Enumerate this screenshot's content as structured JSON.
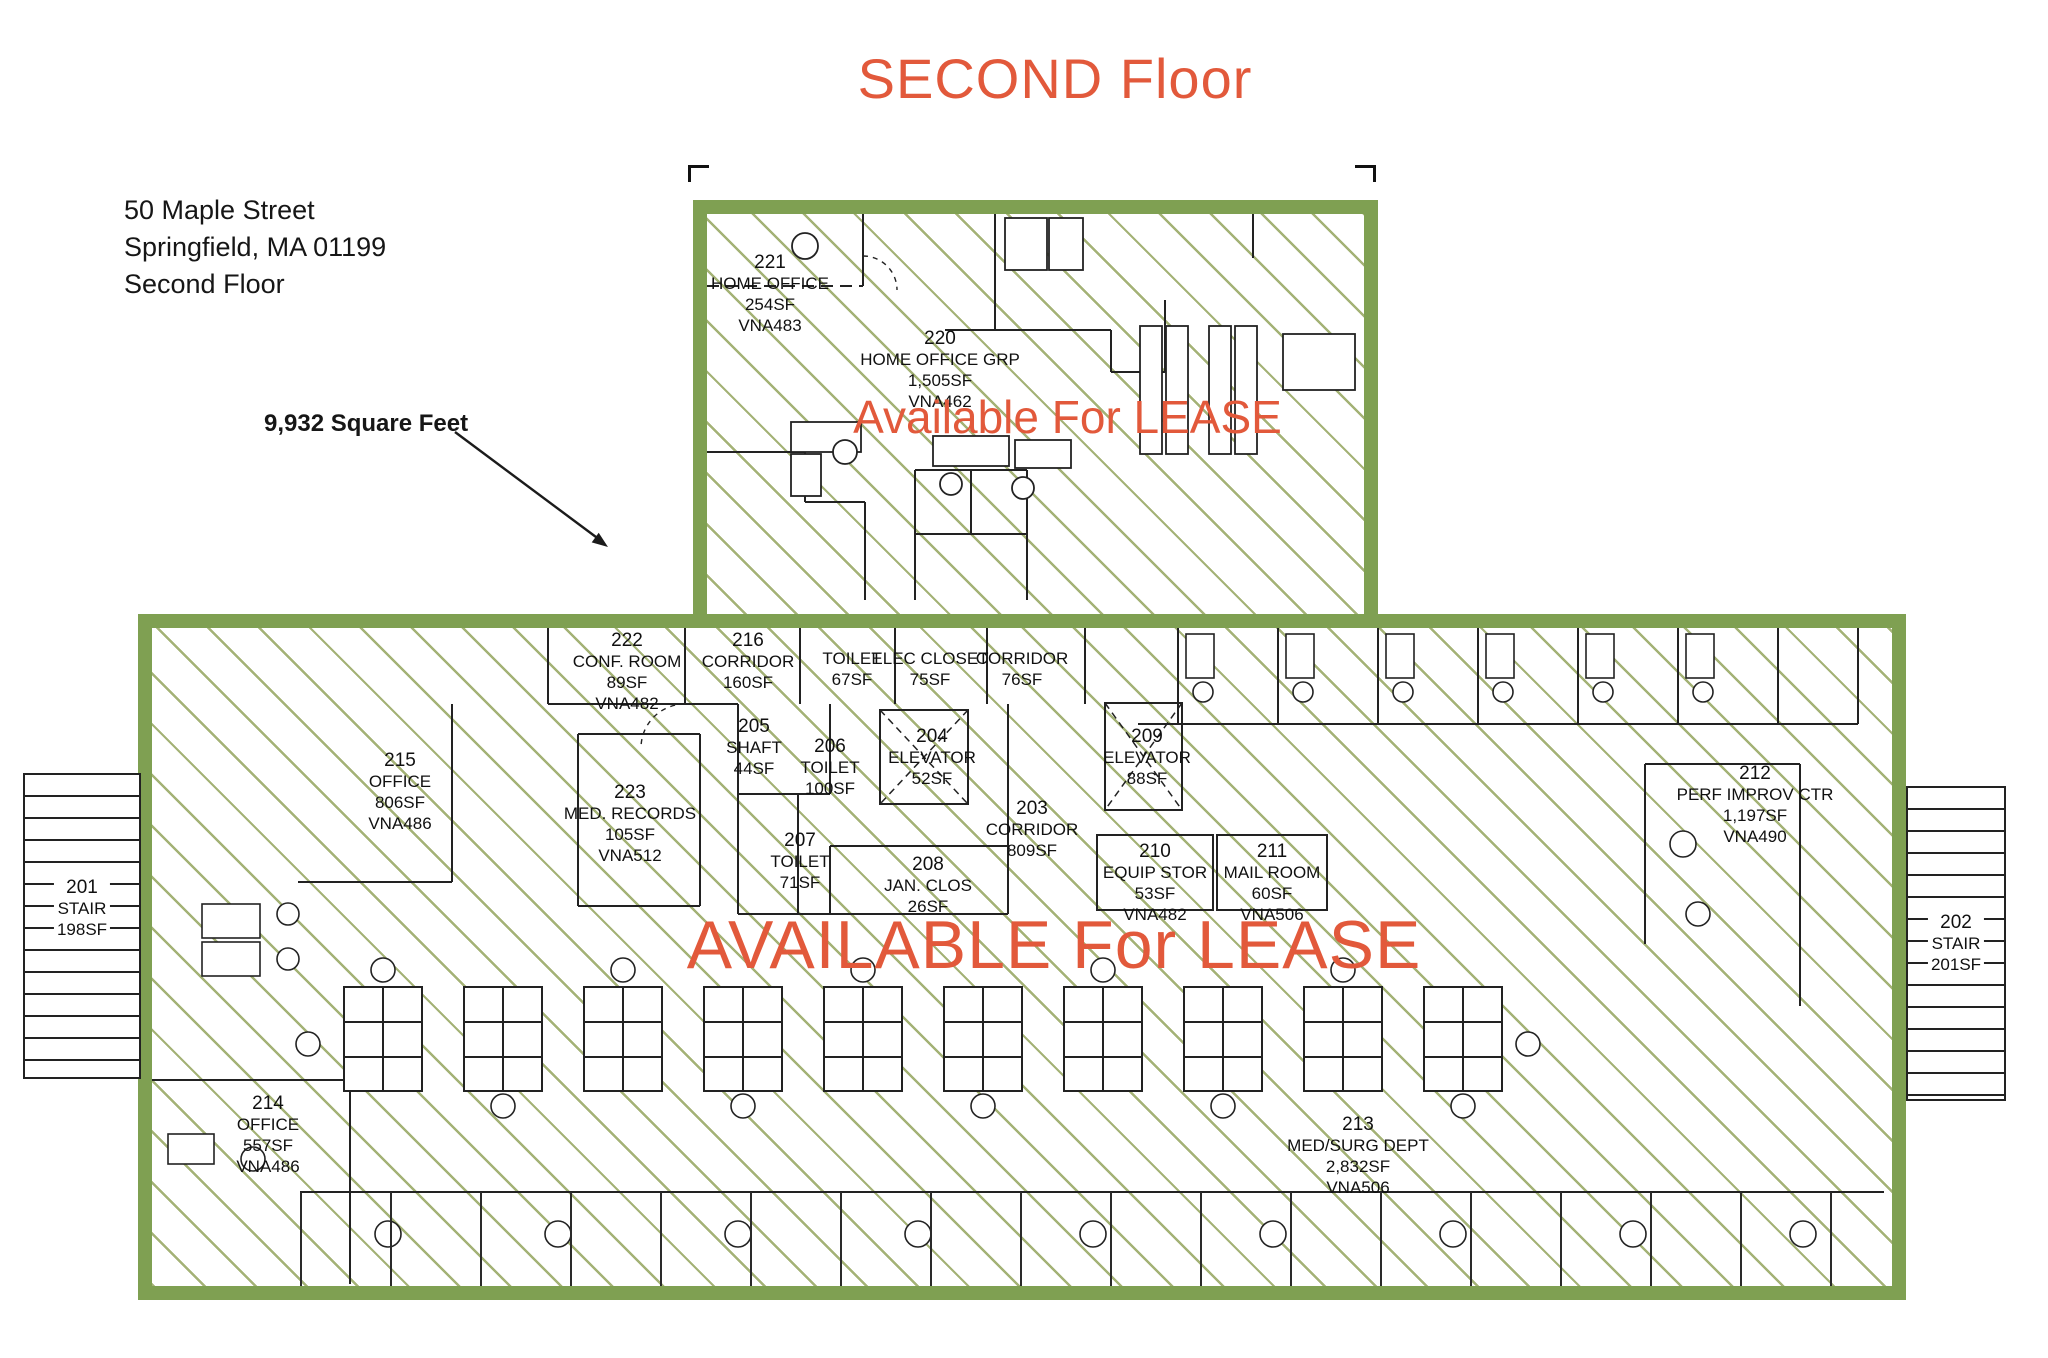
{
  "title": "SECOND Floor",
  "address": [
    "50 Maple Street",
    "Springfield, MA 01199",
    "Second Floor"
  ],
  "square_feet_note": "9,932 Square Feet",
  "lease": {
    "upper_label": "Available For LEASE",
    "lower_label": "AVAILABLE For LEASE"
  },
  "colors": {
    "accent_orange": "#E2593B",
    "lease_border_green": "#7FA052",
    "hatch_green": "#94A45E",
    "ink": "#1F1F1F"
  },
  "upper_unit": {
    "rooms": [
      {
        "number": "221",
        "name": "HOME OFFICE",
        "area": "254SF",
        "code": "VNA483"
      },
      {
        "number": "220",
        "name": "HOME OFFICE GRP",
        "area": "1,505SF",
        "code": "VNA462"
      }
    ]
  },
  "lower_unit": {
    "rooms": [
      {
        "number": "222",
        "name": "CONF. ROOM",
        "area": "89SF",
        "code": "VNA482"
      },
      {
        "number": "216",
        "name": "CORRIDOR",
        "area": "160SF"
      },
      {
        "name": "TOILET",
        "area": "67SF"
      },
      {
        "name": "ELEC CLOSET",
        "area": "75SF"
      },
      {
        "name": "CORRIDOR",
        "area": "76SF"
      },
      {
        "number": "215",
        "name": "OFFICE",
        "area": "806SF",
        "code": "VNA486"
      },
      {
        "number": "223",
        "name": "MED. RECORDS",
        "area": "105SF",
        "code": "VNA512"
      },
      {
        "number": "205",
        "name": "SHAFT",
        "area": "44SF"
      },
      {
        "number": "206",
        "name": "TOILET",
        "area": "100SF"
      },
      {
        "number": "204",
        "name": "ELEVATOR",
        "area": "52SF"
      },
      {
        "number": "207",
        "name": "TOILET",
        "area": "71SF"
      },
      {
        "number": "208",
        "name": "JAN. CLOS",
        "area": "26SF"
      },
      {
        "number": "203",
        "name": "CORRIDOR",
        "area": "809SF"
      },
      {
        "number": "209",
        "name": "ELEVATOR",
        "area": "88SF"
      },
      {
        "number": "210",
        "name": "EQUIP STOR",
        "area": "53SF",
        "code": "VNA482"
      },
      {
        "number": "211",
        "name": "MAIL ROOM",
        "area": "60SF",
        "code": "VNA506"
      },
      {
        "number": "212",
        "name": "PERF IMPROV CTR",
        "area": "1,197SF",
        "code": "VNA490"
      },
      {
        "number": "214",
        "name": "OFFICE",
        "area": "557SF",
        "code": "VNA486"
      },
      {
        "number": "213",
        "name": "MED/SURG DEPT",
        "area": "2,832SF",
        "code": "VNA506"
      }
    ]
  },
  "stairs": [
    {
      "number": "201",
      "name": "STAIR",
      "area": "198SF"
    },
    {
      "number": "202",
      "name": "STAIR",
      "area": "201SF"
    }
  ]
}
